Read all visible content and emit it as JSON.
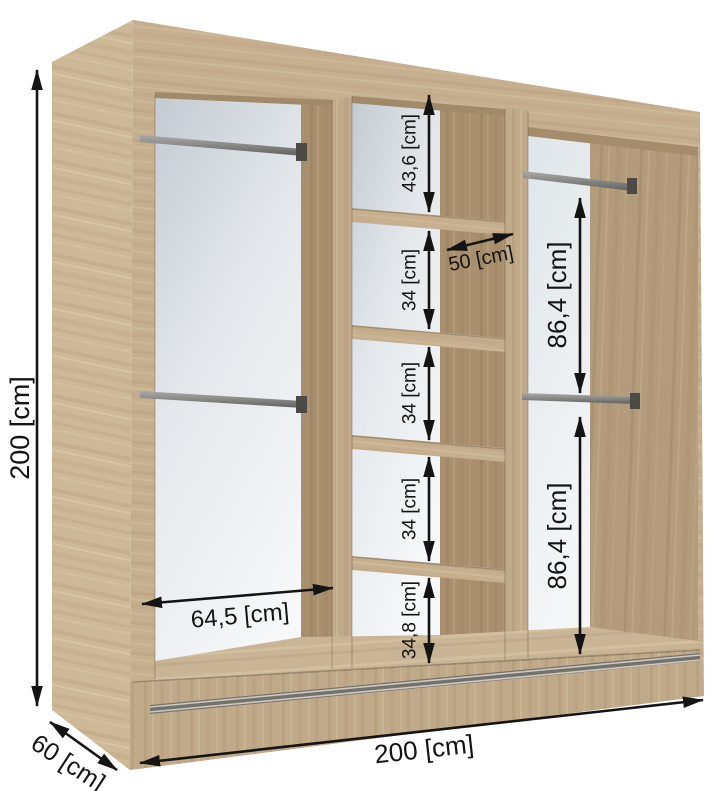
{
  "diagram": {
    "type": "wardrobe-dimension-diagram",
    "unit": "cm",
    "overall": {
      "height": "200 [cm]",
      "width": "200 [cm]",
      "depth": "60 [cm]"
    },
    "left_section": {
      "inner_width": "64,5 [cm]",
      "rails": 2
    },
    "middle_section": {
      "shelf_width": "50 [cm]",
      "gaps": [
        "43,6 [cm]",
        "34 [cm]",
        "34 [cm]",
        "34 [cm]",
        "34,8 [cm]"
      ]
    },
    "right_section": {
      "gaps": [
        "86,4 [cm]",
        "86,4 [cm]"
      ],
      "rails": 2
    },
    "colors": {
      "wood_front": "#c6af8e",
      "wood_side": "#cdb897",
      "wood_inner": "#a98f6e",
      "back_panel": "#e4e8ec",
      "dimension_lines": "#141414",
      "metal": "#8b8b89"
    }
  }
}
